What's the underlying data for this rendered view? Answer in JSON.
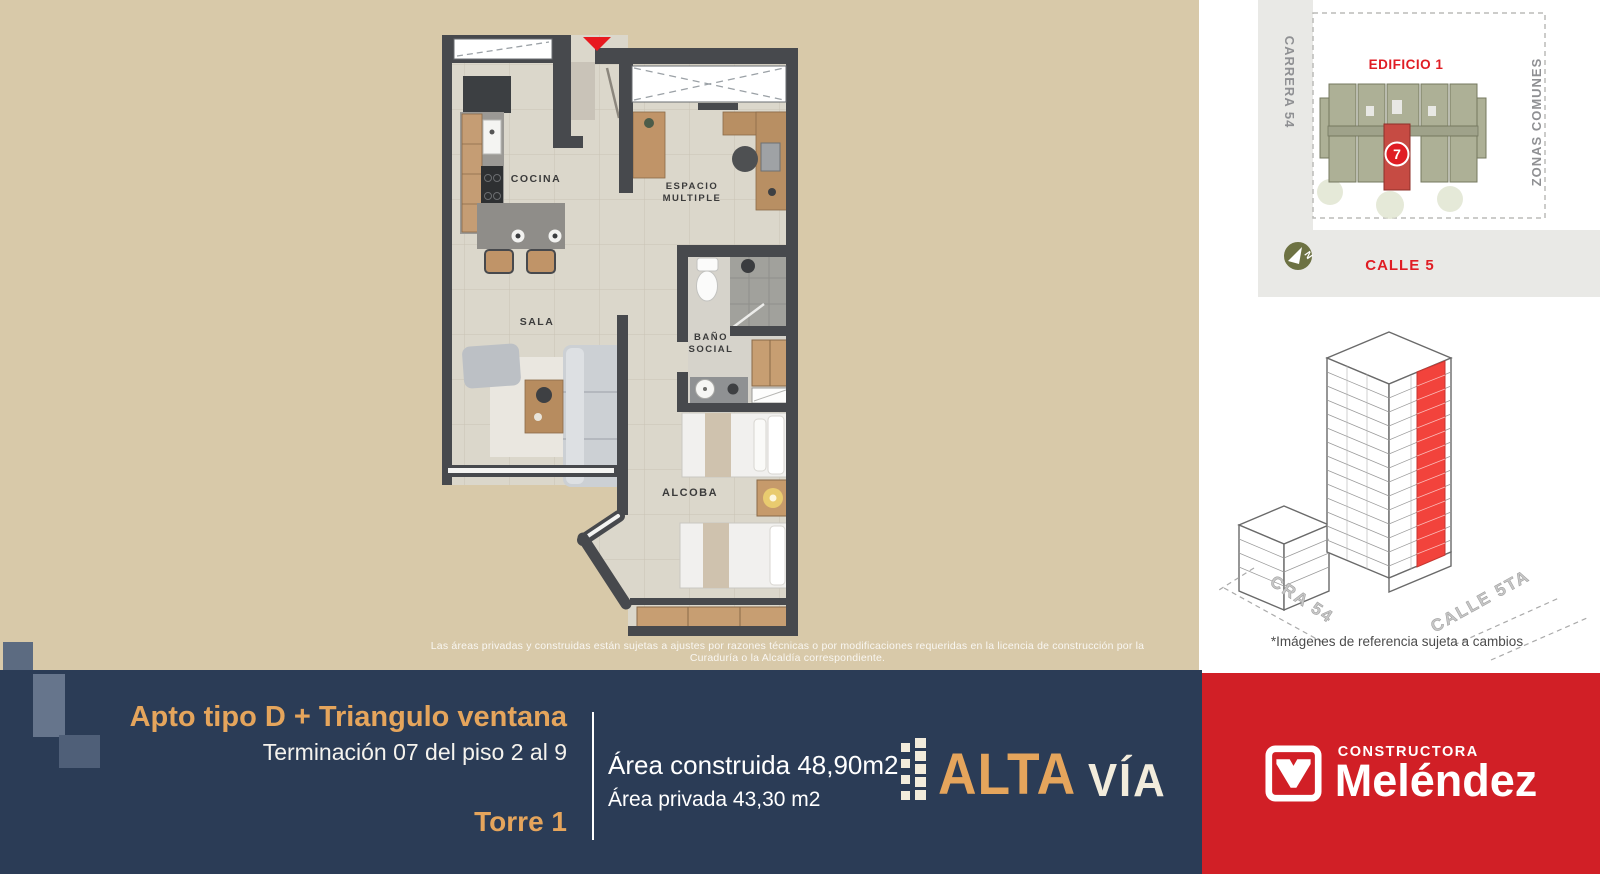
{
  "colors": {
    "background": "#d8c9a9",
    "navy": "#2b3c56",
    "brand_red": "#d11f26",
    "accent_red": "#e01d24",
    "gold": "#e5a55c",
    "cream": "#f2ecdc",
    "wall": "#47494d"
  },
  "floorplan": {
    "rooms": {
      "cocina": "COCINA",
      "sala": "SALA",
      "espacio_line1": "ESPACIO",
      "espacio_line2": "MULTIPLE",
      "bano_line1": "BAÑO",
      "bano_line2": "SOCIAL",
      "alcoba": "ALCOBA"
    }
  },
  "disclaimer": "Las áreas privadas y construidas están sujetas a ajustes por razones técnicas o por modificaciones requeridas en la licencia de construcción por la Curaduría o la Alcaldía correspondiente.",
  "sitemap": {
    "street_left": "CARRERA 54",
    "building_label": "EDIFICIO 1",
    "zones_label": "ZONAS COMUNES",
    "street_bottom": "CALLE 5",
    "unit_number": "7"
  },
  "render": {
    "street_left": "CRA 54",
    "street_right": "CALLE 5TA"
  },
  "reference_note": "*Imágenes de referencia sujeta a cambios",
  "info": {
    "title": "Apto tipo D + Triangulo ventana",
    "subtitle": "Terminación 07 del piso 2 al 9",
    "tower": "Torre 1",
    "area_built": "Área construida 48,90m2",
    "area_private": "Área privada 43,30 m2"
  },
  "altavia": {
    "part1": "ALTA",
    "part2": "VÍA"
  },
  "melendez": {
    "top": "CONSTRUCTORA",
    "name": "Meléndez"
  }
}
